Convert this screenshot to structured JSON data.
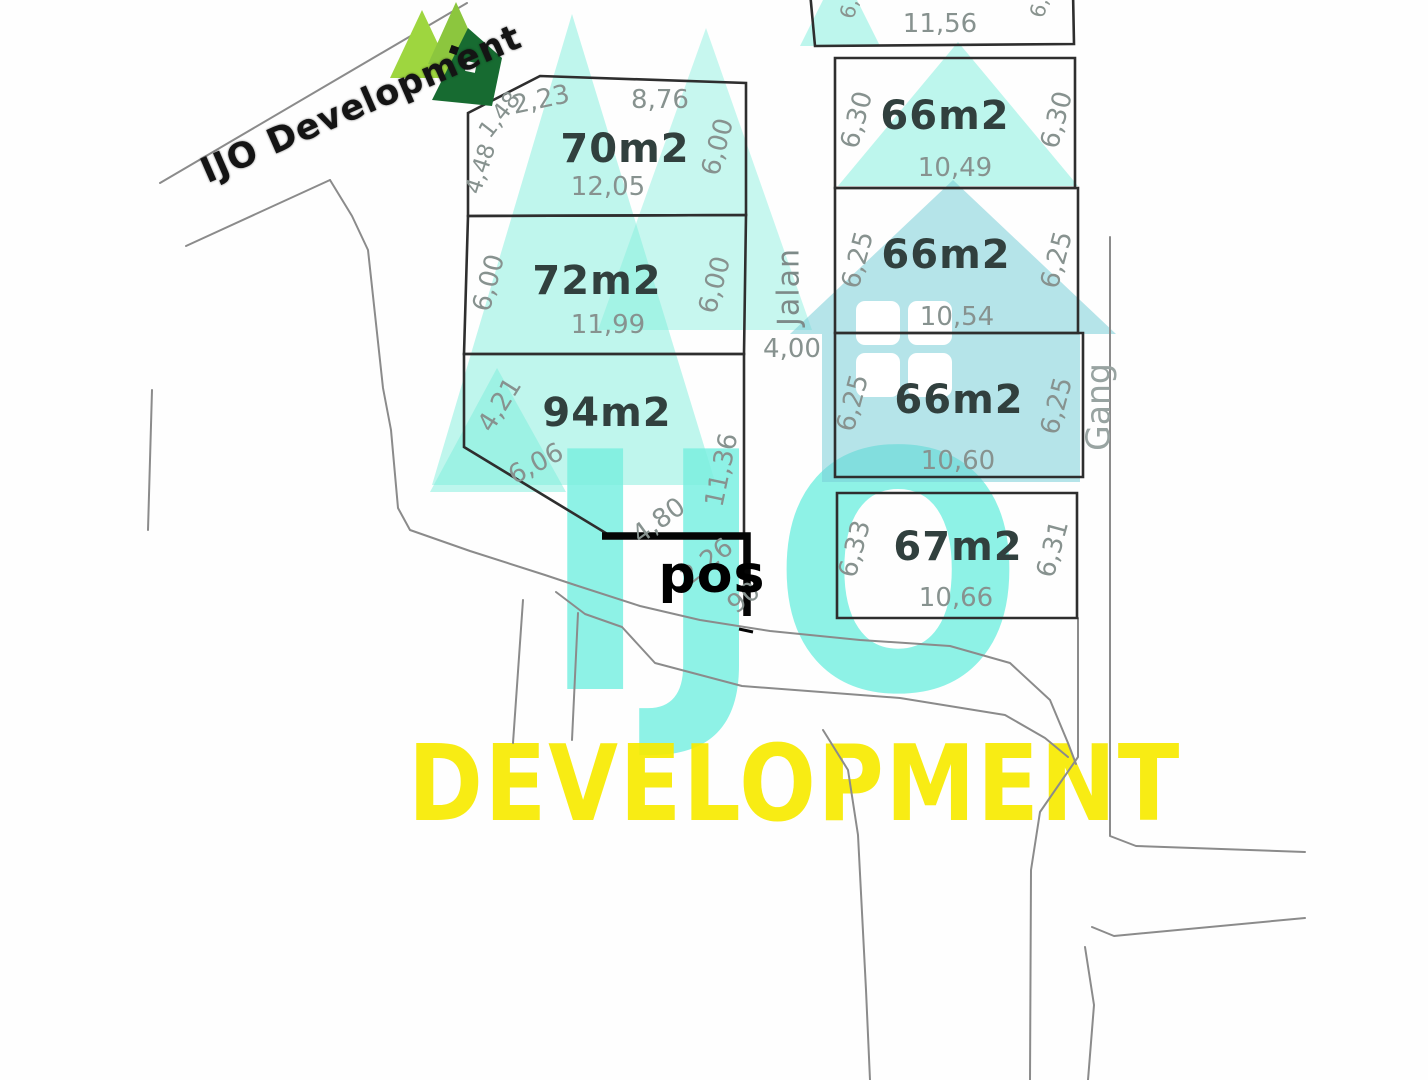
{
  "brand": {
    "logo_text": "IJO Development",
    "watermark_line1": "IJO",
    "watermark_line2": "DEVELOPMENT",
    "teal": "#6fe8d8",
    "teal_house": "#78cdd7",
    "yellow": "#f7ea00",
    "logo_green_light": "#8cc63e",
    "logo_green_dark": "#14692e"
  },
  "map": {
    "road_label_vertical": "Jalan",
    "road_width_label": "4,00",
    "alley_label": "Gang",
    "post_label": "pos",
    "top_plot": {
      "bottom_dim": "11,56",
      "edge_fragment_left": "6,3",
      "edge_fragment_right": "6,3"
    },
    "plots_left": [
      {
        "area": "70m2",
        "dims": {
          "top_cut": "1,48",
          "top_left": "2,23",
          "top": "8,76",
          "left": "4,48",
          "right": "6,00",
          "bottom": "12,05"
        }
      },
      {
        "area": "72m2",
        "dims": {
          "left": "6,00",
          "right": "6,00",
          "bottom": "11,99"
        }
      },
      {
        "area": "94m2",
        "dims": {
          "left": "4,21",
          "diag": "6,06",
          "right": "11,36",
          "bottom": "4,80",
          "road_a": "2,26",
          "road_b": "90"
        }
      }
    ],
    "plots_right": [
      {
        "area": "66m2",
        "dims": {
          "left": "6,30",
          "right": "6,30",
          "bottom": "10,49"
        }
      },
      {
        "area": "66m2",
        "dims": {
          "left": "6,25",
          "right": "6,25",
          "bottom": "10,54"
        }
      },
      {
        "area": "66m2",
        "dims": {
          "left": "6,25",
          "right": "6,25",
          "bottom": "10,60"
        }
      },
      {
        "area": "67m2",
        "dims": {
          "left": "6,33",
          "right": "6,31",
          "bottom": "10,66"
        }
      }
    ]
  }
}
